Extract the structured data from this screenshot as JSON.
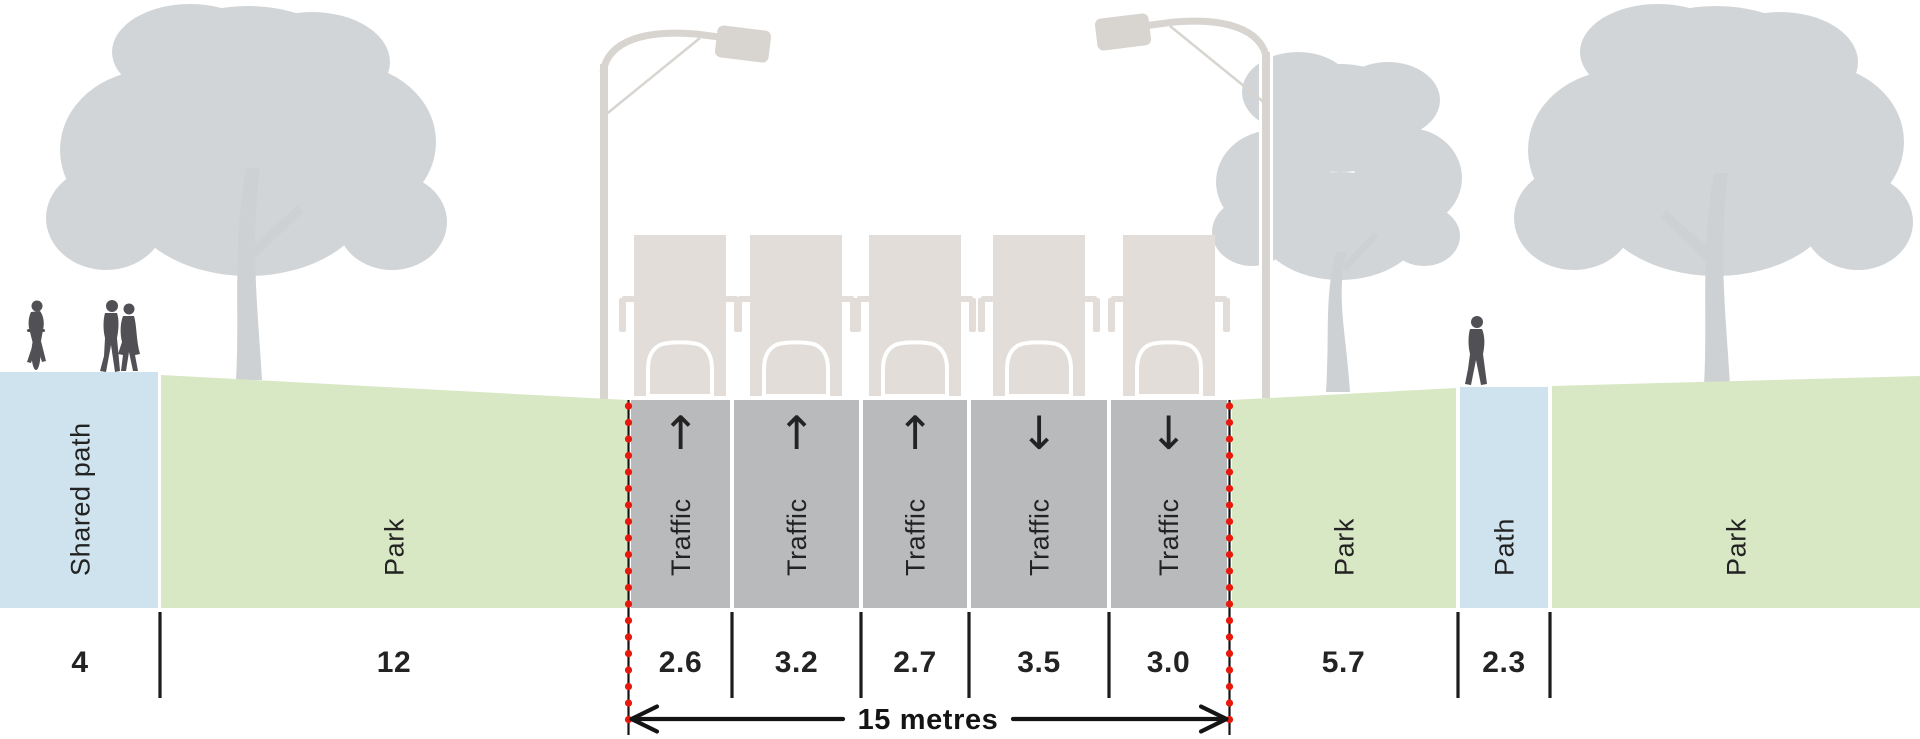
{
  "diagram": {
    "type": "street-cross-section",
    "units": "metres",
    "scale_px_per_metre": 40
  },
  "colors": {
    "background": "#ffffff",
    "path_blue": "#cfe3ee",
    "park_green": "#d8e7c4",
    "road_gray": "#b9babc",
    "tree_gray": "#d2d5d7",
    "truck_beige": "#e2ddd8",
    "lamp_gray": "#d8d4d0",
    "person_dark": "#515155",
    "text_dark": "#232323",
    "marker_red": "#e8190c",
    "line_black": "#141414"
  },
  "segments": [
    {
      "id": "shared-path-left",
      "kind": "path",
      "label": "Shared path",
      "value": "4"
    },
    {
      "id": "park-left",
      "kind": "park",
      "label": "Park",
      "value": "12"
    },
    {
      "id": "lane-1",
      "kind": "traffic",
      "label": "Traffic",
      "value": "2.6",
      "arrow": "↑",
      "direction": "up"
    },
    {
      "id": "lane-2",
      "kind": "traffic",
      "label": "Traffic",
      "value": "3.2",
      "arrow": "↑",
      "direction": "up"
    },
    {
      "id": "lane-3",
      "kind": "traffic",
      "label": "Traffic",
      "value": "2.7",
      "arrow": "↑",
      "direction": "up"
    },
    {
      "id": "lane-4",
      "kind": "traffic",
      "label": "Traffic",
      "value": "3.5",
      "arrow": "↓",
      "direction": "down"
    },
    {
      "id": "lane-5",
      "kind": "traffic",
      "label": "Traffic",
      "value": "3.0",
      "arrow": "↓",
      "direction": "down"
    },
    {
      "id": "park-right",
      "kind": "park",
      "label": "Park",
      "value": "5.7"
    },
    {
      "id": "path-right",
      "kind": "path",
      "label": "Path",
      "value": "2.3"
    },
    {
      "id": "park-far-right",
      "kind": "park",
      "label": "Park",
      "value": ""
    }
  ],
  "dimension": {
    "label": "15 metres",
    "total_metres": 15,
    "spans": "traffic lanes"
  },
  "scenery": {
    "trees": 3,
    "street_lamps": 2,
    "trucks": 5,
    "people": [
      "cyclist",
      "walking couple",
      "pedestrian"
    ]
  }
}
